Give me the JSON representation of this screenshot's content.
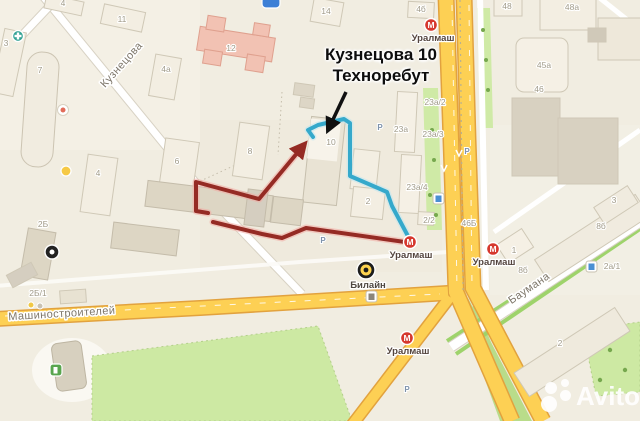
{
  "colors": {
    "route_red": "#952b24",
    "route_red_halo": "#f2aaa2",
    "route_blue": "#35a9cb",
    "route_blue_halo": "#bfe6f0",
    "metro_red": "#d6382e",
    "road_yellow": "#fdd054",
    "road_casing": "#e2a23e",
    "park_green": "#cde9a3",
    "annotation_black": "#101010"
  },
  "annotation": {
    "line1": "Кузнецова 10",
    "line2": "Техноребут"
  },
  "watermark": {
    "brand": "Avito"
  },
  "map": {
    "metro_glyph": "М",
    "parking_glyph": "P",
    "metro_stations": [
      {
        "name": "Уралмаш",
        "cx": 431,
        "cy": 25,
        "lx": 433,
        "ly": 41
      },
      {
        "name": "Уралмаш",
        "cx": 410,
        "cy": 242,
        "lx": 411,
        "ly": 258
      },
      {
        "name": "Уралмаш",
        "cx": 493,
        "cy": 249,
        "lx": 494,
        "ly": 265
      },
      {
        "name": "Уралмаш",
        "cx": 407,
        "cy": 338,
        "lx": 408,
        "ly": 354
      }
    ],
    "street_labels": [
      {
        "t": "Кузнецова",
        "x": 124,
        "y": 67,
        "rot": -48,
        "s": 11
      },
      {
        "t": "Машиностроителей",
        "x": 62,
        "y": 317,
        "rot": -3.5,
        "s": 12
      },
      {
        "t": "Баумана",
        "x": 531,
        "y": 291,
        "rot": -34,
        "s": 11
      }
    ],
    "building_labels": [
      {
        "t": "4",
        "x": 63,
        "y": 6
      },
      {
        "t": "11",
        "x": 122,
        "y": 22
      },
      {
        "t": "3",
        "x": 6,
        "y": 46
      },
      {
        "t": "7",
        "x": 40,
        "y": 73
      },
      {
        "t": "4а",
        "x": 166,
        "y": 72
      },
      {
        "t": "12",
        "x": 231,
        "y": 51
      },
      {
        "t": "14",
        "x": 326,
        "y": 14
      },
      {
        "t": "4б",
        "x": 421,
        "y": 12
      },
      {
        "t": "4",
        "x": 98,
        "y": 176
      },
      {
        "t": "6",
        "x": 177,
        "y": 164
      },
      {
        "t": "8",
        "x": 250,
        "y": 154
      },
      {
        "t": "10",
        "x": 331,
        "y": 145
      },
      {
        "t": "2",
        "x": 368,
        "y": 204
      },
      {
        "t": "23а/2",
        "x": 435,
        "y": 105
      },
      {
        "t": "23а",
        "x": 401,
        "y": 132
      },
      {
        "t": "23а/3",
        "x": 433,
        "y": 137
      },
      {
        "t": "23а/4",
        "x": 417,
        "y": 190
      },
      {
        "t": "2/2",
        "x": 429,
        "y": 223
      },
      {
        "t": "46Б",
        "x": 469,
        "y": 226
      },
      {
        "t": "2Б",
        "x": 43,
        "y": 227
      },
      {
        "t": "2Б/1",
        "x": 38,
        "y": 296
      },
      {
        "t": "48",
        "x": 507,
        "y": 9
      },
      {
        "t": "48а",
        "x": 572,
        "y": 10
      },
      {
        "t": "45а",
        "x": 544,
        "y": 68
      },
      {
        "t": "46",
        "x": 539,
        "y": 92
      },
      {
        "t": "8б",
        "x": 601,
        "y": 229
      },
      {
        "t": "8б",
        "x": 523,
        "y": 273
      },
      {
        "t": "2а/1",
        "x": 612,
        "y": 269
      },
      {
        "t": "1",
        "x": 514,
        "y": 253
      },
      {
        "t": "3",
        "x": 614,
        "y": 203
      },
      {
        "t": "2",
        "x": 560,
        "y": 346
      }
    ],
    "parking": [
      {
        "x": 323,
        "y": 243
      },
      {
        "x": 467,
        "y": 154
      },
      {
        "x": 380,
        "y": 130
      },
      {
        "x": 407,
        "y": 392
      }
    ],
    "poi": {
      "beeline": {
        "name": "Билайн"
      }
    }
  }
}
